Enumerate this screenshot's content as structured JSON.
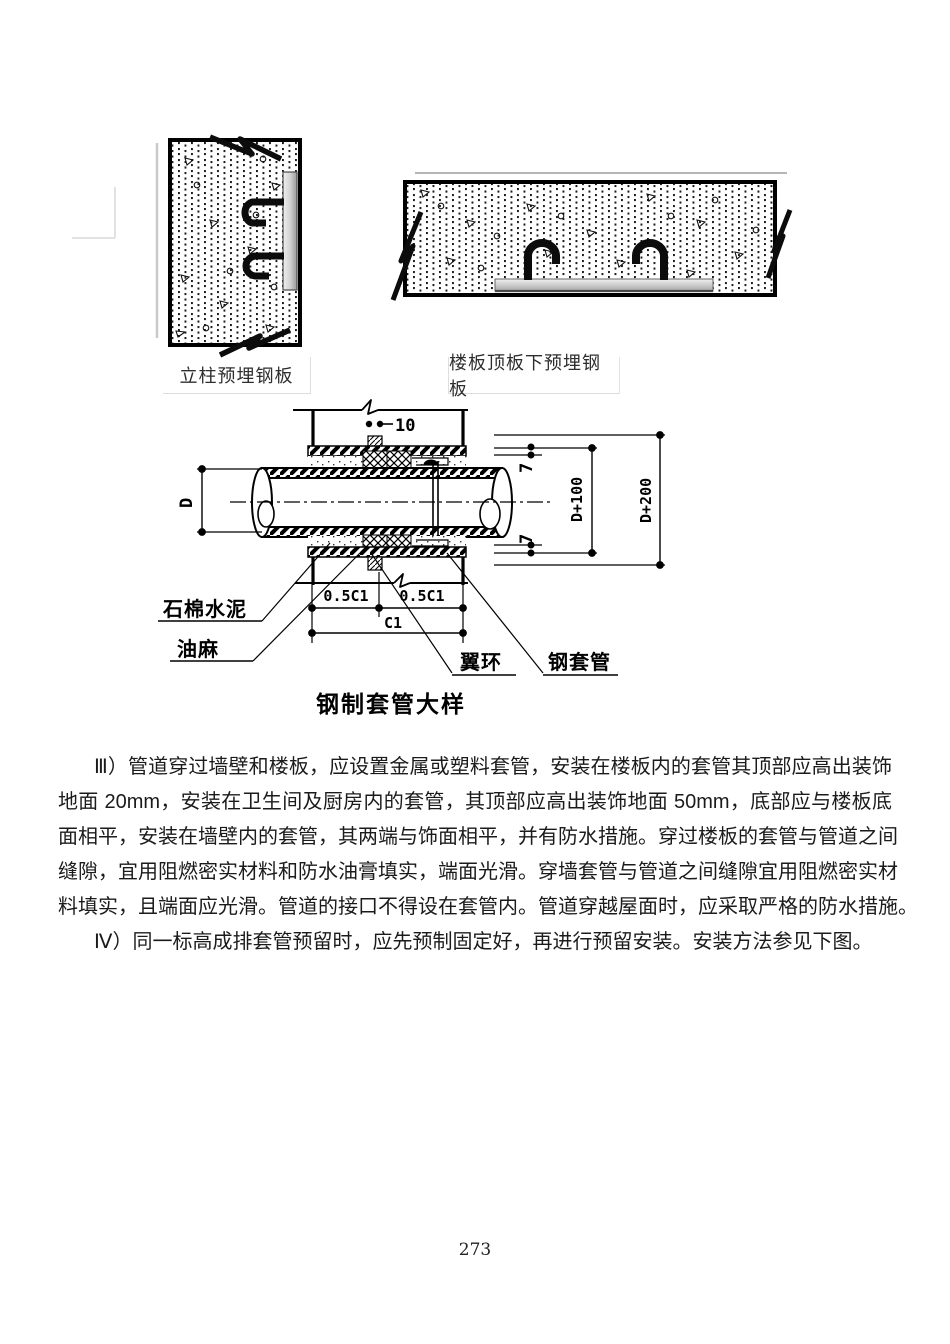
{
  "page": {
    "number": "273"
  },
  "figures": {
    "column_plate": {
      "caption": "立柱预埋钢板"
    },
    "slab_plate": {
      "caption": "楼板顶板下预埋钢板"
    },
    "sleeve_detail": {
      "title": "钢制套管大样",
      "labels": {
        "asbestos_cement": "石棉水泥",
        "oakum": "油麻",
        "wing_ring": "翼环",
        "steel_sleeve": "钢套管"
      },
      "dimensions": {
        "ring_thickness": "10",
        "pipe_diameter": "D",
        "weld_top": "7",
        "weld_bottom": "7",
        "sleeve_diameter": "D+100",
        "hole_diameter": "D+200",
        "half_c1_left": "0.5C1",
        "half_c1_right": "0.5C1",
        "c1": "C1"
      }
    }
  },
  "body": {
    "para1_lines": [
      "Ⅲ）管道穿过墙壁和楼板，应设置金属或塑料套管，安装在楼板内的套管其顶部应高出装饰",
      "地面 20mm，安装在卫生间及厨房内的套管，其顶部应高出装饰地面 50mm，底部应与楼板底",
      "面相平，安装在墙壁内的套管，其两端与饰面相平，并有防水措施。穿过楼板的套管与管道之间",
      "缝隙，宜用阻燃密实材料和防水油膏填实，端面光滑。穿墙套管与管道之间缝隙宜用阻燃密实材",
      "料填实，且端面应光滑。管道的接口不得设在套管内。管道穿越屋面时，应采取严格的防水措施。"
    ],
    "para2": "Ⅳ）同一标高成排套管预留时，应先预制固定好，再进行预留安装。安装方法参见下图。"
  }
}
